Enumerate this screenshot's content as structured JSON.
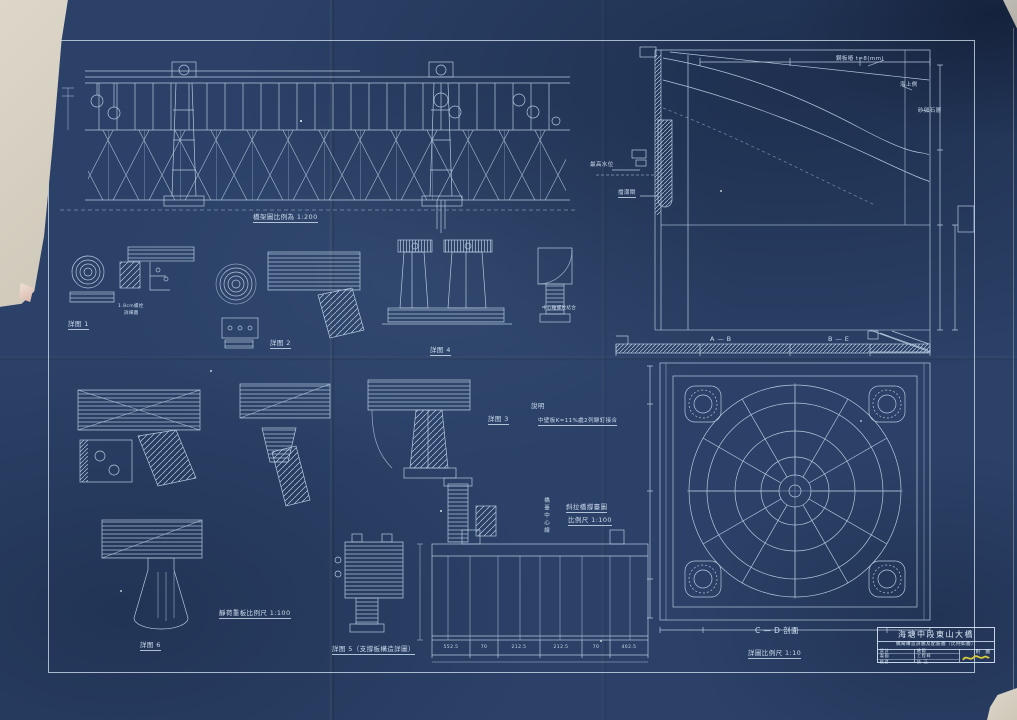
{
  "captions": {
    "truss": "橋架圖比例為 1:200",
    "load": "靜荷重板比例尺 1:100",
    "support_l1": "斜拉橋撐臺圖",
    "support_l2": "比例尺 1:100",
    "section_ab": "A — B",
    "section_be": "B — E",
    "cd_section": "C — D  剖面",
    "cd_scale": "詳圖比例尺 1:10"
  },
  "details": {
    "d1": "詳图 1",
    "d2": "詳图 2",
    "d3": "詳图 3",
    "d4": "詳图 4",
    "d5": "詳图 5（支撐板構造詳圖）",
    "d6": "詳图 6"
  },
  "notes": {
    "note_title": "說明",
    "note_body": "中壁板K=11%處2列鉚釘接合",
    "bolt_note_l1": "1.8cm螺栓",
    "bolt_note_l2": "詳細圖",
    "axis_note": "中心軸螺栓結合"
  },
  "annotations": {
    "steel_sheet": "鋼板樁 t=8(mm)",
    "sea_side": "海上側",
    "sand_layer": "砂卵石層",
    "max_water": "最高水位",
    "tide_gate": "擋潮閘",
    "centerline": "橋臺中心線"
  },
  "dims": {
    "bottom": [
      "552.5",
      "70",
      "212.5",
      "212.5",
      "70",
      "402.5"
    ]
  },
  "title_block": {
    "title": "海塘中段東山大橋",
    "subtitle": "橋閘構造詳圖及配筋圖（比例如圖）",
    "side_label": "附 圖",
    "rows": [
      {
        "l": "設計",
        "r": "繪圖"
      },
      {
        "l": "製圖",
        "r": "工程師"
      },
      {
        "l": "校對",
        "r": "技 正"
      }
    ]
  }
}
